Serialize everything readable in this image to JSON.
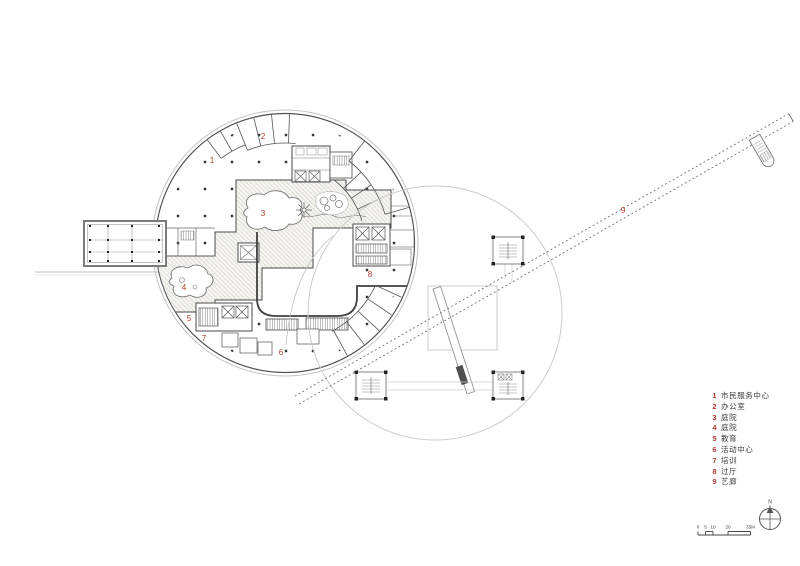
{
  "legend": {
    "items": [
      {
        "num": "1",
        "label": "市民服务中心"
      },
      {
        "num": "2",
        "label": "办公室"
      },
      {
        "num": "3",
        "label": "庭院"
      },
      {
        "num": "4",
        "label": "庭院"
      },
      {
        "num": "5",
        "label": "教育"
      },
      {
        "num": "6",
        "label": "活动中心"
      },
      {
        "num": "7",
        "label": "培训"
      },
      {
        "num": "8",
        "label": "过厅"
      },
      {
        "num": "9",
        "label": "艺廊"
      }
    ]
  },
  "plan_labels": [
    {
      "n": "1"
    },
    {
      "n": "2"
    },
    {
      "n": "3"
    },
    {
      "n": "4"
    },
    {
      "n": "5"
    },
    {
      "n": "6"
    },
    {
      "n": "7"
    },
    {
      "n": "8"
    },
    {
      "n": "9"
    }
  ],
  "scale_bar": {
    "ticks": [
      "0",
      "5",
      "10",
      "20",
      "35M"
    ]
  },
  "north": {
    "label": "N"
  },
  "colors": {
    "label_red": "#b23a31",
    "wall_dark": "#4a4a4a",
    "line_light": "#c6c6c6",
    "hatch_bg": "#f5f4f1"
  }
}
